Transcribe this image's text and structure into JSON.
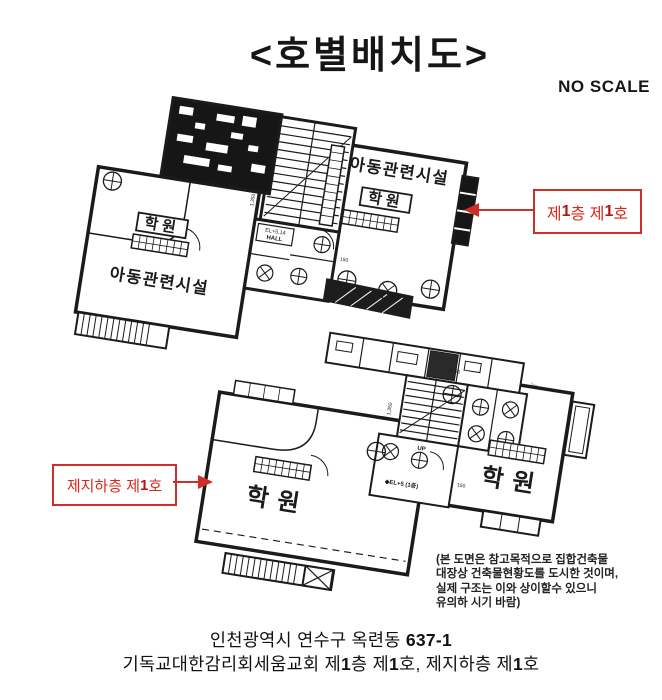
{
  "document": {
    "background": "#ffffff"
  },
  "title": "<호별배치도>",
  "scale_note": "NO SCALE",
  "callouts": {
    "first_floor": {
      "parts": [
        "제",
        "1",
        "층 제",
        "1",
        "호"
      ]
    },
    "basement": {
      "parts": [
        "제지하층 제",
        "1",
        "호"
      ]
    }
  },
  "plans": {
    "first_floor": {
      "left_wing": {
        "boxed_label": "학원",
        "room_label": "아동관련시설"
      },
      "right_wing": {
        "boxed_label": "학원",
        "room_label": "아동관련시설"
      },
      "hall": {
        "line1": "EL+5.14",
        "line2": "HALL"
      },
      "dims": {
        "d1": "1,350",
        "d2": "150"
      }
    },
    "basement": {
      "left_wing": {
        "room_label": "학원"
      },
      "right_wing": {
        "room_label": "학원"
      },
      "hall": {
        "level": "◆EL+5 (1층)"
      },
      "stair_label": "UP",
      "dims": {
        "d1": "1,350",
        "d2": "150",
        "d3": "15.00"
      }
    }
  },
  "watermarks": {
    "w1": "교시의 하",
    "w2": "문서는 김포시",
    "w3": "없습"
  },
  "disclaimer": {
    "lines": [
      "(본 도면은 참고목적으로 집합건축물",
      "대장상 건축물현황도를 도시한 것이며,",
      "실제 구조는 이와 상이할수 있으니",
      "유의하 시기 바람)"
    ]
  },
  "address": {
    "line1": {
      "parts": [
        "인천광역시 연수구 옥련동 ",
        "637-1"
      ]
    },
    "line2": {
      "parts": [
        "기독교대한감리회세움교회 제",
        "1",
        "층 제",
        "1",
        "호, 제지하층 제",
        "1",
        "호"
      ]
    }
  },
  "colors": {
    "annotation_red": "#d8281e",
    "ink": "#1b1b1b"
  }
}
